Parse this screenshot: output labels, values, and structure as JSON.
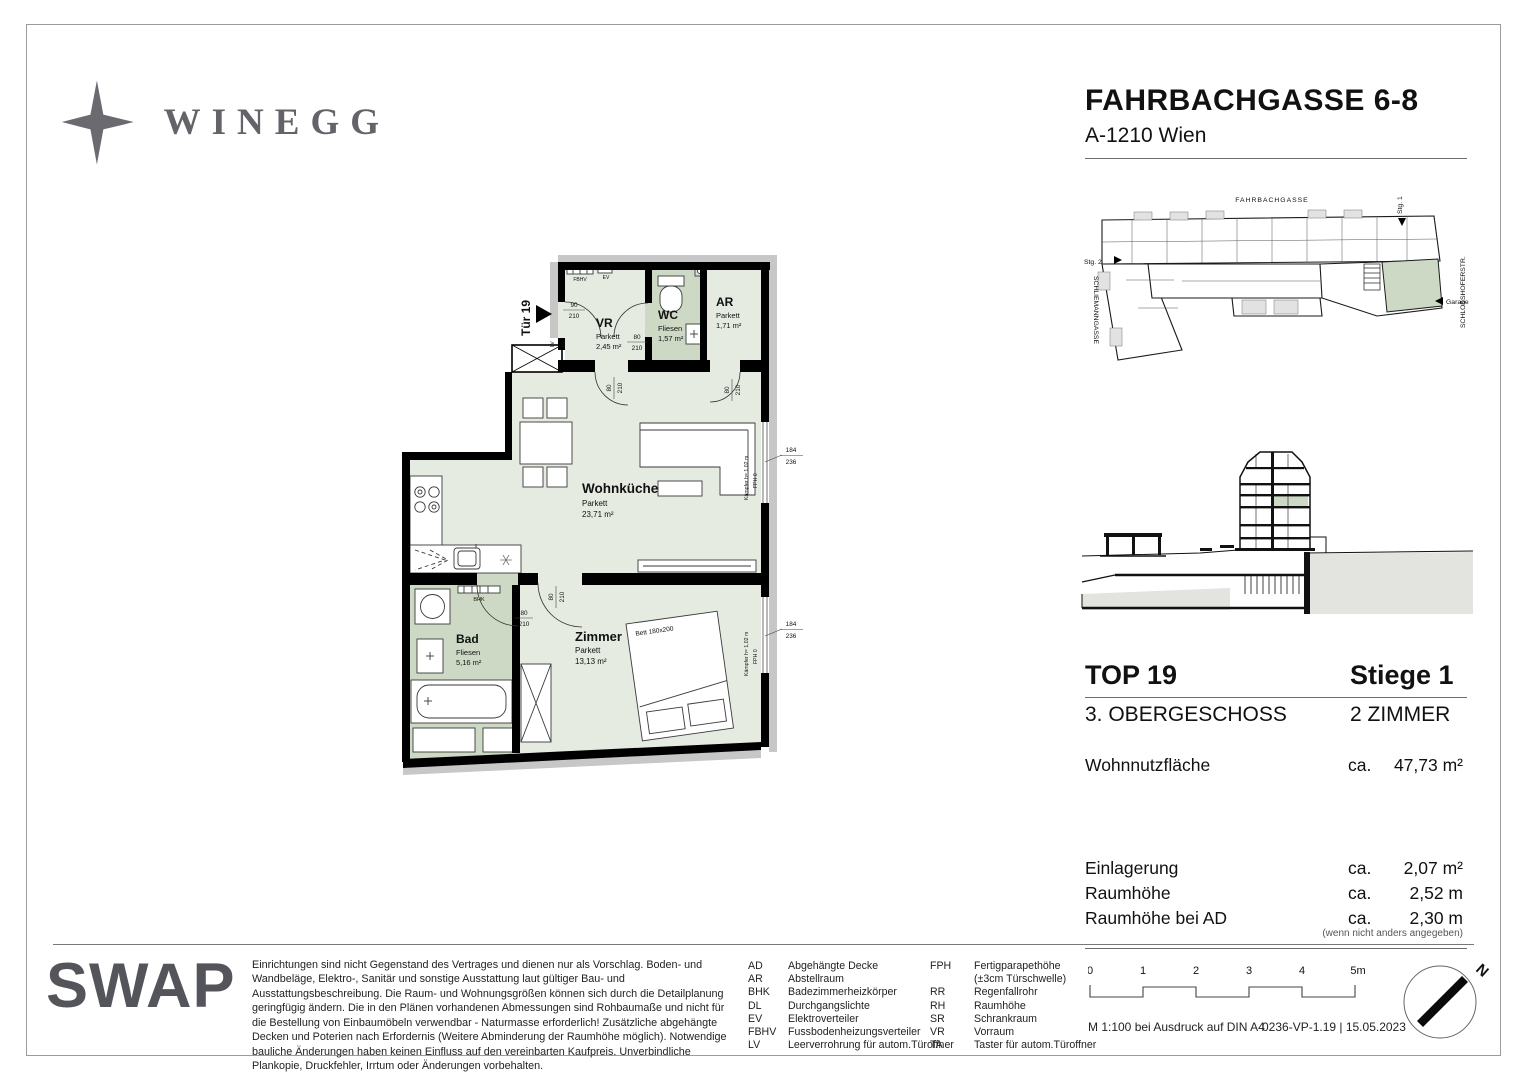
{
  "brand": {
    "name": "WINEGG"
  },
  "header": {
    "title": "FAHRBACHGASSE 6-8",
    "subtitle": "A-1210 Wien"
  },
  "floorplan": {
    "entrance": "Tür 19",
    "rooms": {
      "vr": {
        "name": "VR",
        "floor": "Parkett",
        "area": "2,45 m²"
      },
      "wc": {
        "name": "WC",
        "floor": "Fliesen",
        "area": "1,57 m²"
      },
      "ar": {
        "name": "AR",
        "floor": "Parkett",
        "area": "1,71 m²"
      },
      "wohnkueche": {
        "name": "Wohnküche",
        "floor": "Parkett",
        "area": "23,71 m²"
      },
      "bad": {
        "name": "Bad",
        "floor": "Fliesen",
        "area": "5,16 m²"
      },
      "zimmer": {
        "name": "Zimmer",
        "floor": "Parkett",
        "area": "13,13 m²"
      }
    },
    "dims": {
      "entrance": {
        "w": "90",
        "h": "210"
      },
      "door": {
        "w": "80",
        "h": "210"
      },
      "window": {
        "w": "184",
        "h": "236"
      }
    },
    "ann": {
      "lv": "LV",
      "fbhv": "FBHV",
      "ev": "EV",
      "bhk": "BHK",
      "bett": "Bett 180x200",
      "kaempfer": "Kämpfer h= 1,02 m",
      "fph": "FPH 0"
    }
  },
  "siteplan": {
    "street_top": "FAHRBACHGASSE",
    "street_right": "SCHLOSSHOFERSTR.",
    "street_left": "SCHLIEMANNGASSE",
    "stg1": "Stg. 1",
    "stg2": "Stg. 2",
    "garage": "Garage"
  },
  "unit": {
    "top": "TOP 19",
    "stiege": "Stiege 1",
    "floor": "3. OBERGESCHOSS",
    "rooms": "2 ZIMMER",
    "area_row": {
      "label": "Wohnnutzfläche",
      "ca": "ca.",
      "value": "47,73 m²"
    },
    "rows": [
      {
        "label": "Einlagerung",
        "ca": "ca.",
        "value": "2,07 m²"
      },
      {
        "label": "Raumhöhe",
        "ca": "ca.",
        "value": "2,52 m"
      },
      {
        "label": "Raumhöhe bei AD",
        "ca": "ca.",
        "value": "2,30 m"
      }
    ],
    "note": "(wenn nicht anders angegeben)"
  },
  "footer": {
    "logo": "SWAP",
    "disclaimer": "Einrichtungen sind nicht Gegenstand des Vertrages und dienen nur als Vorschlag. Boden- und Wandbeläge, Elektro-, Sanitär und sonstige Ausstattung laut gültiger Bau- und Ausstattungsbeschreibung. Die Raum- und Wohnungsgrößen können sich durch die Detailplanung geringfügig ändern. Die in den Plänen vorhandenen Abmessungen sind Rohbaumaße und nicht für die Bestellung von Einbaumöbeln verwendbar - Naturmasse erforderlich! Zusätzliche abgehängte Decken und Poterien nach Erfordernis (Weitere Abminderung der Raumhöhe möglich). Notwendige bauliche Änderungen haben keinen Einfluss auf den vereinbarten Kaufpreis. Unverbindliche Plankopie, Druckfehler, Irrtum oder Änderungen vorbehalten.",
    "legend": {
      "col1": [
        {
          "a": "AD",
          "d": "Abgehängte Decke"
        },
        {
          "a": "AR",
          "d": "Abstellraum"
        },
        {
          "a": "BHK",
          "d": "Badezimmerheizkörper"
        },
        {
          "a": "DL",
          "d": "Durchgangslichte"
        },
        {
          "a": "EV",
          "d": "Elektroverteiler"
        },
        {
          "a": "FBHV",
          "d": "Fussbodenheizungsverteiler"
        },
        {
          "a": "LV",
          "d": "Leerverrohrung für autom.Türoffner"
        }
      ],
      "col2": [
        {
          "a": "FPH",
          "d": "Fertigparapethöhe"
        },
        {
          "a": "",
          "d": "(±3cm Türschwelle)"
        },
        {
          "a": "RR",
          "d": "Regenfallrohr"
        },
        {
          "a": "RH",
          "d": "Raumhöhe"
        },
        {
          "a": "SR",
          "d": "Schrankraum"
        },
        {
          "a": "VR",
          "d": "Vorraum"
        },
        {
          "a": "TA",
          "d": "Taster für autom.Türoffner"
        }
      ]
    },
    "scale": {
      "ticks": [
        "0",
        "1",
        "2",
        "3",
        "4",
        "5m"
      ],
      "note": "M 1:100 bei Ausdruck auf DIN A4",
      "ref": "0236-VP-1.19 | 15.05.2023"
    },
    "north": "N"
  }
}
